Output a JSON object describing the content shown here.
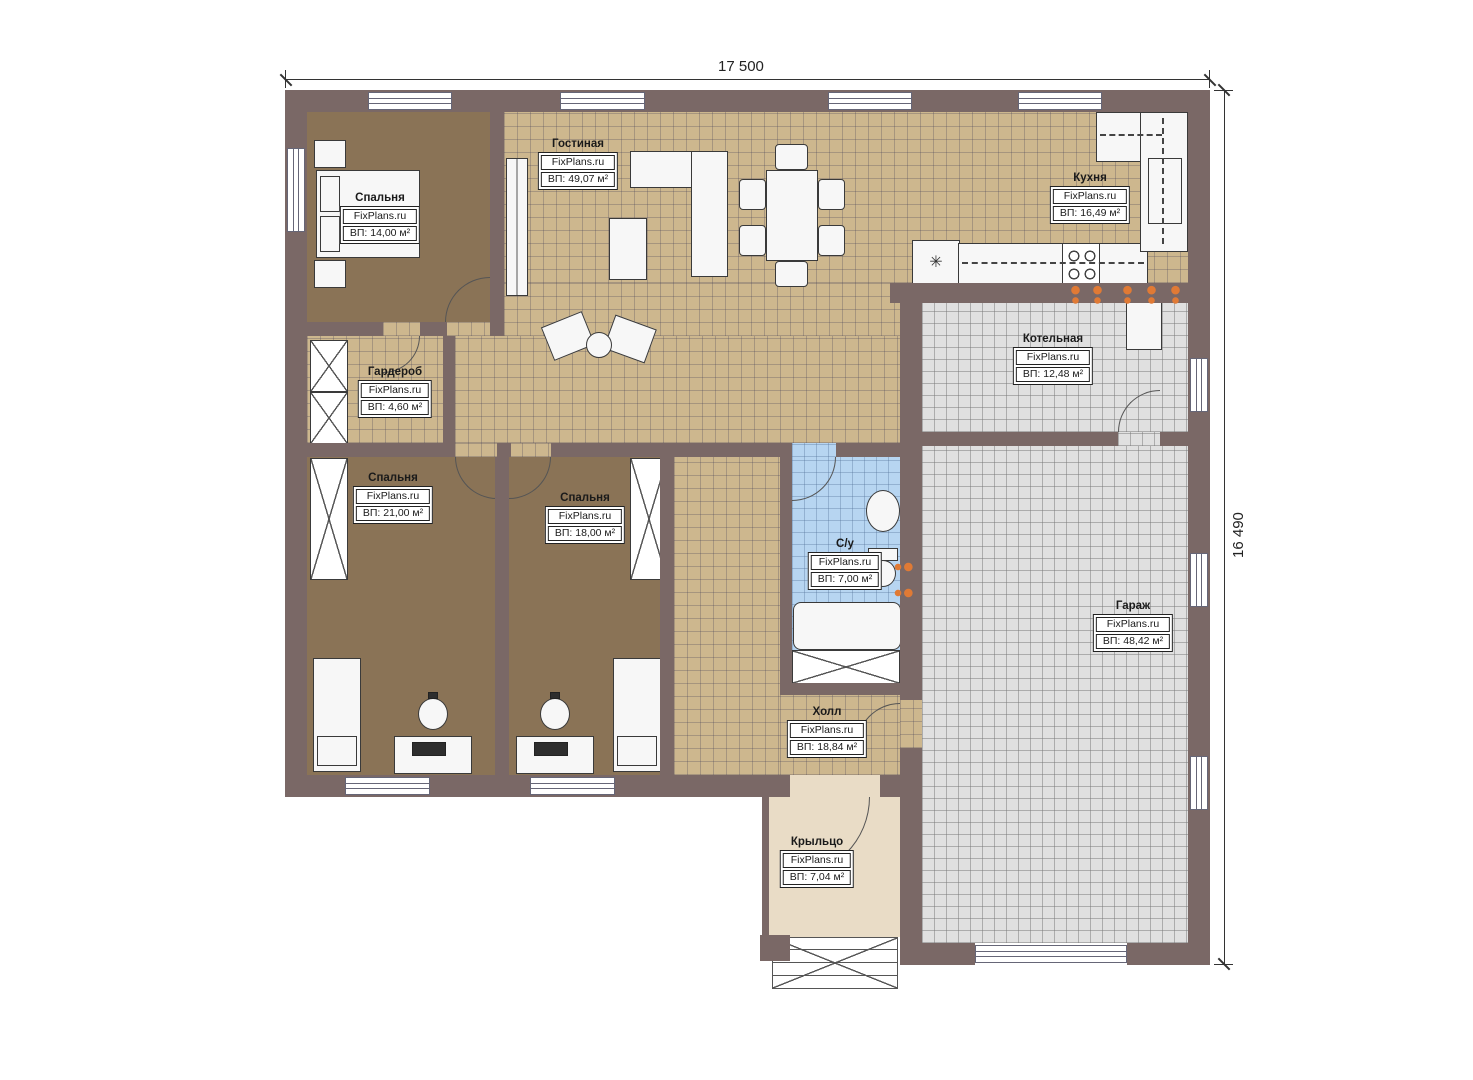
{
  "dimensions": {
    "width_label": "17 500",
    "height_label": "16 490"
  },
  "rooms": [
    {
      "id": "bedroom-1",
      "name": "Спальня",
      "source": "FixPlans.ru",
      "area": "ВП: 14,00 м²"
    },
    {
      "id": "living",
      "name": "Гостиная",
      "source": "FixPlans.ru",
      "area": "ВП: 49,07 м²"
    },
    {
      "id": "kitchen",
      "name": "Кухня",
      "source": "FixPlans.ru",
      "area": "ВП: 16,49 м²"
    },
    {
      "id": "boiler",
      "name": "Котельная",
      "source": "FixPlans.ru",
      "area": "ВП: 12,48 м²"
    },
    {
      "id": "wardrobe",
      "name": "Гардероб",
      "source": "FixPlans.ru",
      "area": "ВП: 4,60 м²"
    },
    {
      "id": "bedroom-2",
      "name": "Спальня",
      "source": "FixPlans.ru",
      "area": "ВП: 21,00 м²"
    },
    {
      "id": "bedroom-3",
      "name": "Спальня",
      "source": "FixPlans.ru",
      "area": "ВП: 18,00 м²"
    },
    {
      "id": "bathroom",
      "name": "С/у",
      "source": "FixPlans.ru",
      "area": "ВП: 7,00 м²"
    },
    {
      "id": "garage",
      "name": "Гараж",
      "source": "FixPlans.ru",
      "area": "ВП: 48,42 м²"
    },
    {
      "id": "hall",
      "name": "Холл",
      "source": "FixPlans.ru",
      "area": "ВП: 18,84 м²"
    },
    {
      "id": "porch",
      "name": "Крыльцо",
      "source": "FixPlans.ru",
      "area": "ВП: 7,04 м²"
    }
  ],
  "icons": {
    "fridge_glyph": "✳"
  },
  "colors": {
    "wall": "#7a6866",
    "beige": "#cdb78e",
    "brown": "#8a7356",
    "gray": "#e0e0e0",
    "blue": "#b7d5f1",
    "porch": "#e9dcc6",
    "orange": "#e07a35",
    "line": "#3a3a3a"
  }
}
